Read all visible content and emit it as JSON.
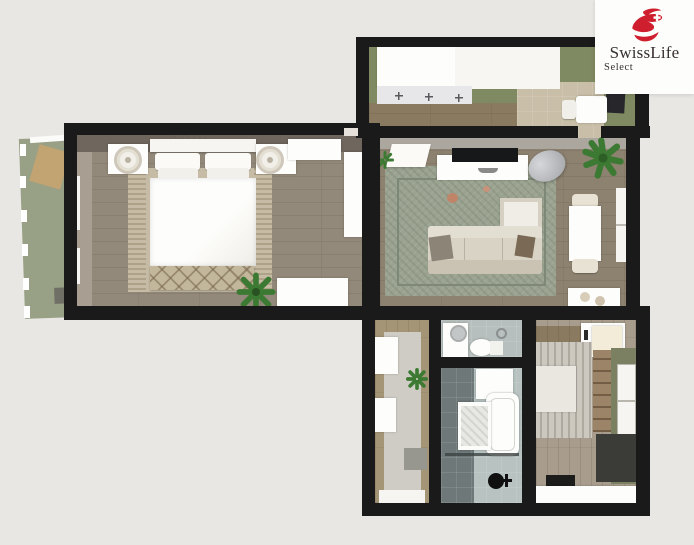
{
  "brand": {
    "name": "SwissLife",
    "subname": "Select",
    "logo_icon": "swisslife-red-swoosh-with-swiss-cross"
  },
  "image": {
    "kind": "3d-floorplan-render",
    "rooms_depicted": [
      "balcony",
      "bedroom",
      "kitchen",
      "living-room",
      "hallway",
      "wc",
      "bathroom",
      "second-room"
    ]
  },
  "colors": {
    "background": "#e9e7e4",
    "card": "#fdfdfc",
    "brand_red": "#cf1f2e",
    "brand_text": "#372f31",
    "wall": "#1a1a1a",
    "bedroom_floor": "#93897a",
    "bedroom_wall_face": "#6f675d",
    "bedroom_rug": "#c6bca6",
    "kitchen_floor": "#7f8a62",
    "kitchen_wood": "#8a7a5f",
    "kitchen_tile": "#c9bfa8",
    "living_floor": "#8d8270",
    "living_rug": "#9ba390",
    "rug_border": "#7e8877",
    "sofa": "#d9d3c5",
    "balcony_floor": "#98a085",
    "hall_wood": "#a59577",
    "hall_floor": "#cfccc5",
    "wc_floor": "#b6bfbd",
    "bath_dark": "#6e7878",
    "bath_light": "#b7c2c1",
    "room2_floor": "#a89d8c",
    "room2_wall": "#7c8063",
    "room2_dark": "#3b3b38",
    "plant_green": "#3c7a33"
  }
}
